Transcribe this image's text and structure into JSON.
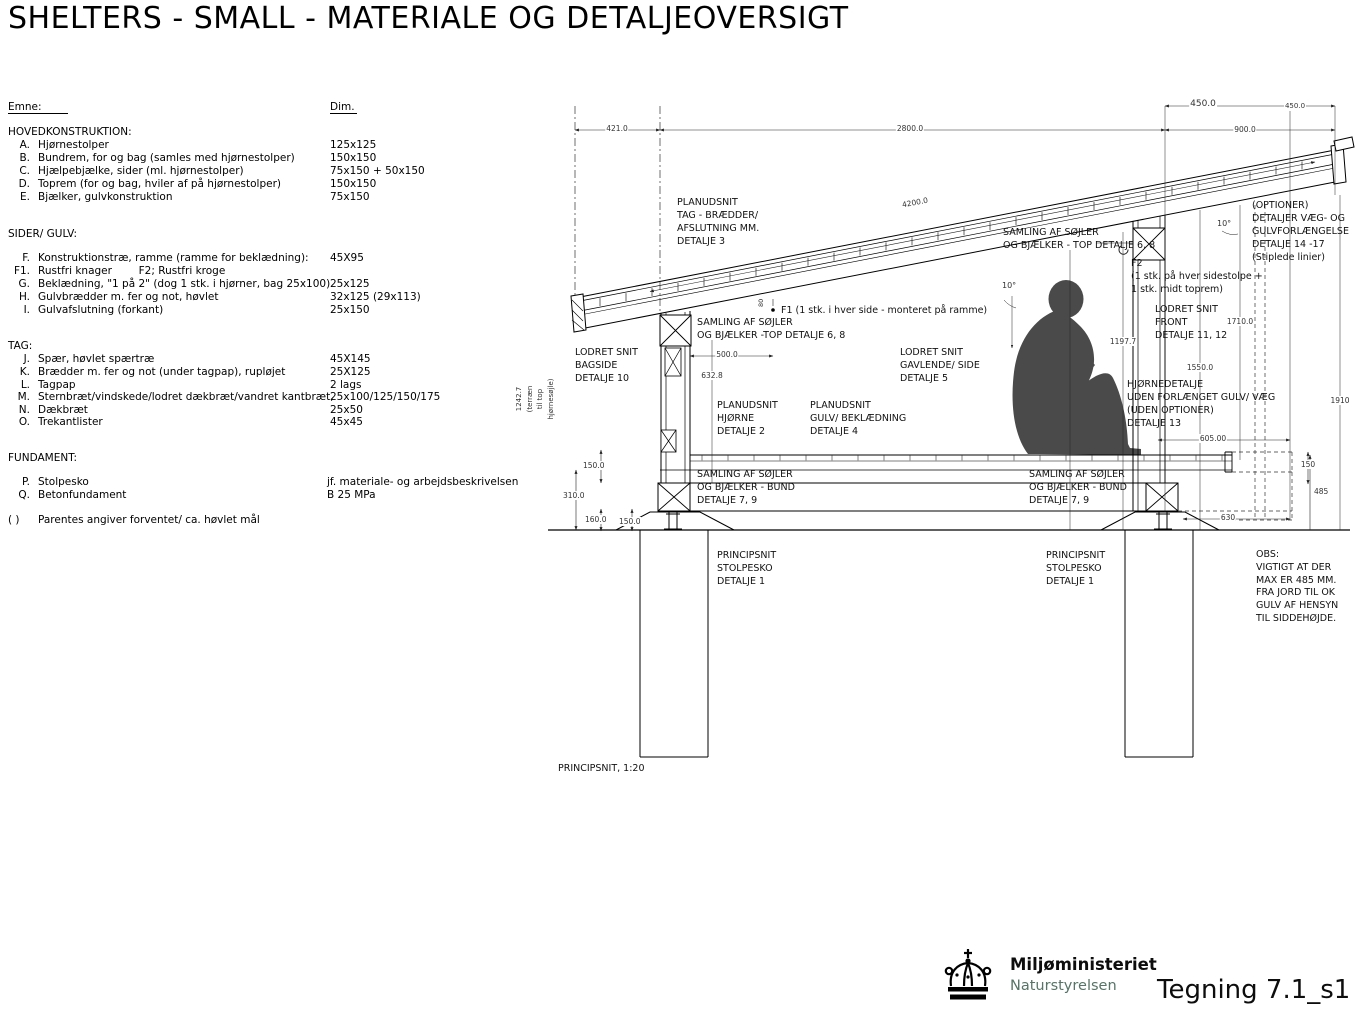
{
  "title": "SHELTERS - SMALL - MATERIALE OG DETALJEOVERSIGT",
  "materials": {
    "col_emne": "Emne:",
    "col_dim": "Dim.",
    "sections": [
      {
        "heading": "HOVEDKONSTRUKTION:",
        "items": [
          {
            "key": "A.",
            "label": "Hjørnestolper",
            "dim": "125x125"
          },
          {
            "key": "B.",
            "label": "Bundrem, for og bag (samles med hjørnestolper)",
            "dim": "150x150"
          },
          {
            "key": "C.",
            "label": "Hjælpebjælke, sider (ml. hjørnestolper)",
            "dim": "75x150 + 50x150"
          },
          {
            "key": "D.",
            "label": "Toprem (for og bag, hviler af på hjørnestolper)",
            "dim": "150x150"
          },
          {
            "key": "E.",
            "label": "Bjælker, gulvkonstruktion",
            "dim": "75x150"
          }
        ]
      },
      {
        "heading": "SIDER/ GULV:",
        "items": [
          {
            "key": "F.",
            "label": "Konstruktionstræ, ramme (ramme for beklædning):",
            "dim": "45X95"
          },
          {
            "key": "F1.",
            "label": "Rustfri knager        F2; Rustfri kroge",
            "dim": ""
          },
          {
            "key": "G.",
            "label": "Beklædning, \"1 på 2\" (dog 1 stk. i hjørner, bag 25x100)",
            "dim": "25x125"
          },
          {
            "key": "H.",
            "label": "Gulvbrædder m. fer og not, høvlet",
            "dim": "32x125 (29x113)"
          },
          {
            "key": "I.",
            "label": "Gulvafslutning (forkant)",
            "dim": "25x150"
          }
        ]
      },
      {
        "heading": "TAG:",
        "items": [
          {
            "key": "J.",
            "label": "Spær, høvlet spærtræ",
            "dim": "45X145"
          },
          {
            "key": "K.",
            "label": "Brædder m. fer og not (under tagpap), rupløjet",
            "dim": "25X125"
          },
          {
            "key": "L.",
            "label": "Tagpap",
            "dim": "2 lags"
          },
          {
            "key": "M.",
            "label": "Sternbræt/vindskede/lodret dækbræt/vandret kantbræt,",
            "dim": "25x100/125/150/175"
          },
          {
            "key": "N.",
            "label": "Dækbræt",
            "dim": "25x50"
          },
          {
            "key": "O.",
            "label": "Trekantlister",
            "dim": "45x45"
          }
        ]
      },
      {
        "heading": "FUNDAMENT:",
        "items": [
          {
            "key": "P.",
            "label": "Stolpesko",
            "dim": "jf. materiale- og arbejdsbeskrivelsen"
          },
          {
            "key": "Q.",
            "label": "Betonfundament",
            "dim": "B 25 MPa"
          }
        ]
      }
    ],
    "footnote_key": "( )",
    "footnote": "Parentes angiver forventet/ ca. høvlet mål"
  },
  "drawing": {
    "caption": "PRINCIPSNIT, 1:20",
    "labels": {
      "planudsnit_tag": "PLANUDSNIT\nTAG - BRÆDDER/\nAFSLUTNING MM.\nDETALJE 3",
      "samling_top_right": "SAMLING AF SØJLER\nOG BJÆLKER - TOP DETALJE 6, 8",
      "optioner": "(OPTIONER)\nDETALJER VÆG- OG\nGULVFORLÆNGELSE\nDETALJE 14 -17\n(Stiplede linier)",
      "f2_note": "F2\n(1 stk. på hver sidestolpe +\n1 stk. midt toprem)",
      "lodret_front": "LODRET SNIT\nFRONT\nDETALJE 11, 12",
      "f1_note": "F1 (1 stk. i hver side - monteret på ramme)",
      "samling_top_left": "SAMLING AF SØJLER\nOG BJÆLKER -TOP DETALJE 6, 8",
      "lodret_bagside": "LODRET SNIT\nBAGSIDE\nDETALJE 10",
      "lodret_gavl": "LODRET SNIT\nGAVLENDE/ SIDE\nDETALJE 5",
      "planudsnit_hjorne": "PLANUDSNIT\nHJØRNE\nDETALJE 2",
      "planudsnit_gulv": "PLANUDSNIT\nGULV/ BEKLÆDNING\nDETALJE 4",
      "hjornedetalje": "HJØRNEDETALJE\nUDEN FORLÆNGET GULV/ VÆG\n(UDEN OPTIONER)\nDETALJE 13",
      "samling_bund": "SAMLING AF SØJLER\nOG BJÆLKER - BUND\nDETALJE 7, 9",
      "principsnit_stolpesko": "PRINCIPSNIT\nSTOLPESKO\nDETALJE 1",
      "obs": "OBS:\nVIGTIGT AT DER\nMAX ER 485 MM.\nFRA JORD TIL OK\nGULV AF HENSYN\nTIL SIDDEHØJDE."
    },
    "dims": {
      "d421": "421.0",
      "d2800": "2800.0",
      "d4200": "4200.0",
      "d450a": "450.0",
      "d450b": "450.0",
      "d900": "900.0",
      "d10a": "10°",
      "d10b": "10°",
      "d500": "500.0",
      "d632": "632.8",
      "d1242": "1242.7\n(terræn\ntil top\nhjørnesøjle)",
      "d150a": "150.0",
      "d310": "310.0",
      "d160": "160.0",
      "d150b": "150.0",
      "d1197": "1197.7",
      "d1710": "1710.0",
      "d1550": "1550.0",
      "d1910": "1910",
      "d605": "605.00",
      "d150c": "150",
      "d485": "485",
      "d630": "630",
      "d80": "80"
    }
  },
  "footer": {
    "ministry": "Miljøministeriet",
    "agency": "Naturstyrelsen",
    "drawing_number": "Tegning 7.1_s1",
    "agency_color": "#567468"
  }
}
